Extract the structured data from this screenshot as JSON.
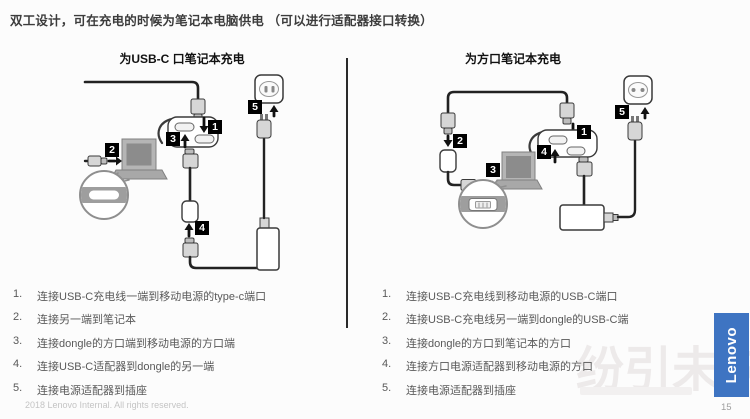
{
  "title": "双工设计，可在充电的时候为笔记本电脑供电 （可以进行适配器接口转换）",
  "left_panel": {
    "heading": "为USB-C 口笔记本充电",
    "badges": [
      "1",
      "2",
      "3",
      "4",
      "5"
    ],
    "steps": [
      {
        "num": "1.",
        "text": "连接USB-C充电线一端到移动电源的type-c端口"
      },
      {
        "num": "2.",
        "text": "连接另一端到笔记本"
      },
      {
        "num": "3.",
        "text": "连接dongle的方口端到移动电源的方口端"
      },
      {
        "num": "4.",
        "text": "连接USB-C适配器到dongle的另一端"
      },
      {
        "num": "5.",
        "text": "连接电源适配器到插座"
      }
    ]
  },
  "right_panel": {
    "heading": "为方口笔记本充电",
    "badges": [
      "1",
      "2",
      "3",
      "4",
      "5"
    ],
    "steps": [
      {
        "num": "1.",
        "text": "连接USB-C充电线到移动电源的USB-C端口"
      },
      {
        "num": "2.",
        "text": "连接USB-C充电线另一端到dongle的USB-C端"
      },
      {
        "num": "3.",
        "text": "连接dongle的方口到笔记本的方口"
      },
      {
        "num": "4.",
        "text": "连接方口电源适配器到移动电源的方口"
      },
      {
        "num": "5.",
        "text": "连接电源适配器到插座"
      }
    ]
  },
  "footer": {
    "copyright": "2018 Lenovo Internal. All rights reserved.",
    "page_number": "15"
  },
  "logo": {
    "text": "Lenovo",
    "color": "#3e74c2"
  },
  "watermark": {
    "text": "纷引未来"
  }
}
